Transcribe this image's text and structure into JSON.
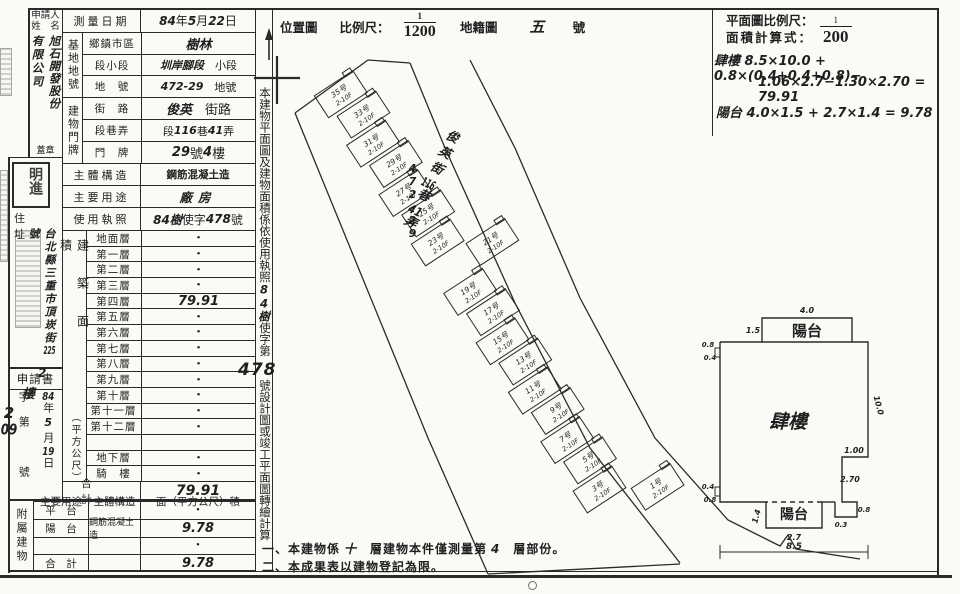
{
  "applicant": {
    "label_line1": "申請人",
    "label_line2": "姓　名",
    "name_col_right": "旭石開發股份",
    "name_col_left": "有限公司",
    "seal_caption": "蓋章",
    "seal_stamp": "明進"
  },
  "address": {
    "label": "住　址",
    "segments": [
      {
        "t": "台北縣三重市",
        "hw": true
      },
      {
        "t": "頂崁街",
        "hw": true
      },
      {
        "t": "225",
        "hw": true,
        "tcu": true
      },
      {
        "t": "號",
        "hw": true
      }
    ]
  },
  "application": {
    "title": "申請書",
    "hw_note_a": "2",
    "hw_note_b": "樓",
    "date_segments": [
      {
        "t": "84",
        "hw": true,
        "tcu": true
      },
      {
        "t": "年"
      },
      {
        "t": "5",
        "hw": true
      },
      {
        "t": "月"
      },
      {
        "t": "19",
        "hw": true,
        "tcu": true
      },
      {
        "t": "日"
      }
    ],
    "no_segments": [
      {
        "t": "字第"
      },
      {
        "t": "　"
      },
      {
        "t": "號"
      }
    ],
    "number_segments": [
      {
        "t": "2",
        "hw": true
      },
      {
        "t": "09",
        "hw": true,
        "tcu": true
      }
    ]
  },
  "survey_date": {
    "label": "測量日期",
    "segments": [
      {
        "t": "84",
        "hw": true
      },
      {
        "t": "年"
      },
      {
        "t": "5",
        "hw": true
      },
      {
        "t": "月"
      },
      {
        "t": "22",
        "hw": true
      },
      {
        "t": "日"
      }
    ]
  },
  "site": {
    "group_label": "基地地號",
    "rows": [
      {
        "label": "鄉鎮市區",
        "segments": [
          {
            "t": "樹林",
            "hw": true
          }
        ]
      },
      {
        "label": "段小段",
        "segments": [
          {
            "t": "圳岸腳段",
            "hw": true
          },
          {
            "t": "　小段"
          }
        ]
      },
      {
        "label": "地　號",
        "segments": [
          {
            "t": "472-29",
            "hw": true
          },
          {
            "t": "　地號"
          }
        ]
      }
    ]
  },
  "door": {
    "group_label": "建物門牌",
    "rows": [
      {
        "label": "街　路",
        "segments": [
          {
            "t": "俊英",
            "hw": true
          },
          {
            "t": "　街路"
          }
        ]
      },
      {
        "label": "段巷弄",
        "segments": [
          {
            "t": "段"
          },
          {
            "t": "116",
            "hw": true
          },
          {
            "t": "巷"
          },
          {
            "t": "41",
            "hw": true
          },
          {
            "t": "弄"
          }
        ]
      },
      {
        "label": "門　牌",
        "segments": [
          {
            "t": "29",
            "hw": true
          },
          {
            "t": "號 "
          },
          {
            "t": "4",
            "hw": true
          },
          {
            "t": "樓"
          }
        ]
      }
    ]
  },
  "structure": {
    "label": "主體構造",
    "value": "鋼筋混凝土造"
  },
  "usage": {
    "label": "主要用途",
    "value": "廠房"
  },
  "license": {
    "label": "使用執照",
    "segments": [
      {
        "t": "84樹",
        "hw": true
      },
      {
        "t": "使字"
      },
      {
        "t": "478",
        "hw": true
      },
      {
        "t": "號"
      }
    ]
  },
  "floor_area": {
    "group_label_main": "建築面積",
    "group_label_unit": "（平方公尺）",
    "rows": [
      {
        "label": "地面層",
        "value": "•"
      },
      {
        "label": "第一層",
        "value": "•"
      },
      {
        "label": "第二層",
        "value": "•"
      },
      {
        "label": "第三層",
        "value": "•"
      },
      {
        "label": "第四層",
        "value": "79.91",
        "hw": true
      },
      {
        "label": "第五層",
        "value": "•"
      },
      {
        "label": "第六層",
        "value": "•"
      },
      {
        "label": "第七層",
        "value": "•"
      },
      {
        "label": "第八層",
        "value": "•"
      },
      {
        "label": "第九層",
        "value": "•"
      },
      {
        "label": "第十層",
        "value": "•"
      },
      {
        "label": "第十一層",
        "value": "•"
      },
      {
        "label": "第十二層",
        "value": "•"
      },
      {
        "label": "",
        "value": ""
      },
      {
        "label": "地下層",
        "value": "•"
      },
      {
        "label": "騎　樓",
        "value": "•"
      }
    ],
    "total_label": "合計",
    "total_value": "79.91"
  },
  "annex": {
    "group_label": "附屬建物",
    "col_headers": [
      "主要用途",
      "主體構造",
      "面（平方公尺）積"
    ],
    "rows": [
      {
        "use": "平　台",
        "structure": "",
        "area": "•"
      },
      {
        "use": "陽　台",
        "structure": "鋼筋混凝土造",
        "area": "9.78"
      },
      {
        "use": "",
        "structure": "",
        "area": "•"
      },
      {
        "use": "合　計",
        "structure": "",
        "area": "9.78"
      }
    ]
  },
  "side_note": {
    "segments": [
      {
        "t": "本建物平面圖及建物面積係依使用執照"
      },
      {
        "t": "84樹",
        "hw": true
      },
      {
        "t": "使字第"
      },
      {
        "t": "　　"
      },
      {
        "t": "號設計圖或竣工平面圖轉繪計算"
      }
    ],
    "license_no": "478"
  },
  "location_map": {
    "title": "位置圖",
    "scale_label": "比例尺：",
    "scale_num": "1",
    "scale_den": "1200",
    "cadastral_label": "地籍圖",
    "cadastral_no": "五",
    "cadastral_suffix": "號",
    "parcel_no": "472-29",
    "road_segments": [
      {
        "t": "俊英街",
        "hw": true
      },
      {
        "t": "116",
        "hw": true,
        "tcu": true
      },
      {
        "t": "巷",
        "hw": true
      },
      {
        "t": "41",
        "hw": true,
        "tcu": true
      },
      {
        "t": "弄",
        "hw": true
      }
    ],
    "house_floors": "2-10F",
    "house_suffix": "号",
    "house_numbers": [
      "35",
      "33",
      "31",
      "29",
      "27",
      "25",
      "23",
      "21",
      "19",
      "17",
      "15",
      "13",
      "11",
      "9",
      "7",
      "5",
      "3",
      "1"
    ]
  },
  "plan_header": {
    "scale_label": "平面圖比例尺：",
    "scale_num": "1",
    "scale_den": "200",
    "calc_label": "面積計算式：",
    "formula1": "肆樓 8.5×10.0 + 0.8×(0.4+0.4+0.8)−",
    "formula2": "1.06×2.7−1.30×2.70 = 79.91",
    "formula3": "陽台 4.0×1.5 + 2.7×1.4 = 9.78"
  },
  "floor_plan": {
    "room": "肆樓",
    "balcony_top": "陽台",
    "balcony_bottom": "陽台",
    "dims": {
      "top_width": "4.0",
      "top_depth": "1.5",
      "right_height": "10.0",
      "step_width": "1.00",
      "step_height": "2.70",
      "bot_balcony_width": "2.7",
      "bot_balcony_depth": "1.4",
      "overall_width": "8.5",
      "jog_top_a": "0.8",
      "jog_top_b": "0.4",
      "jog_bot_a": "0.4",
      "jog_bot_b": "0.8",
      "notch_a": "0.3",
      "notch_b": "0.8"
    }
  },
  "notes": {
    "line1": [
      {
        "t": "一、本建物係 "
      },
      {
        "t": "十",
        "hw": true
      },
      {
        "t": "　層建物本件僅測量第 "
      },
      {
        "t": "4",
        "hw": true
      },
      {
        "t": "　層部份。"
      }
    ],
    "line2": "二、本成果表以建物登記為限。"
  }
}
